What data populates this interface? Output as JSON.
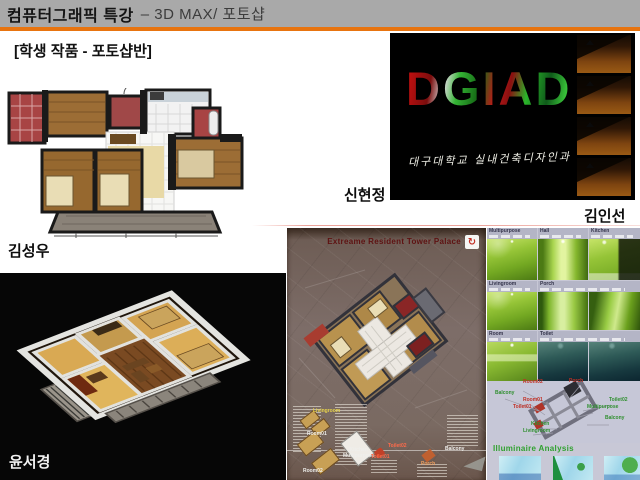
{
  "slide": {
    "header": {
      "title_strong": "컴퓨터그래픽 특강",
      "title_rest": "– 3D MAX/ 포토샵",
      "accent_color": "#e8740f",
      "subtitle": "[학생 작품 - 포토샵반]"
    },
    "credits": {
      "floorplan_author": "김성우",
      "dgiad_author_left": "신현정",
      "dgiad_author_right": "김인선",
      "iso_author": "윤서경"
    },
    "dgiad": {
      "wordmark": "DGIAD",
      "caption": "대구대학교 실내건축디자인과"
    },
    "poster": {
      "title": "Extreame Resident Tower Palace",
      "logo_glyph": "↻",
      "labels": {
        "livingroom": "Livingroom",
        "room01": "Room01",
        "room02": "Room02",
        "kitchen_line1": "Kitchen",
        "kitchen_line2": "Multipurpose",
        "toilet01": "Toilet01",
        "toilet02": "Toilet02",
        "porch": "Porch",
        "balcony": "Balcony"
      }
    },
    "gallery": {
      "row1_headers": [
        "Multipurpose",
        "Hall",
        "Kitchen"
      ],
      "row2_headers": [
        "Livingroom",
        "Porch"
      ],
      "row3_headers": [
        "Room",
        "Toilet"
      ],
      "diagram_labels": [
        "Room02",
        "Porch",
        "Balcony",
        "Room01",
        "Toilet01",
        "Toilet02",
        "Multipurpose",
        "Balcony",
        "Kitchen",
        "Livingroom"
      ],
      "analysis_title": "Illuminaire Analysis"
    }
  }
}
